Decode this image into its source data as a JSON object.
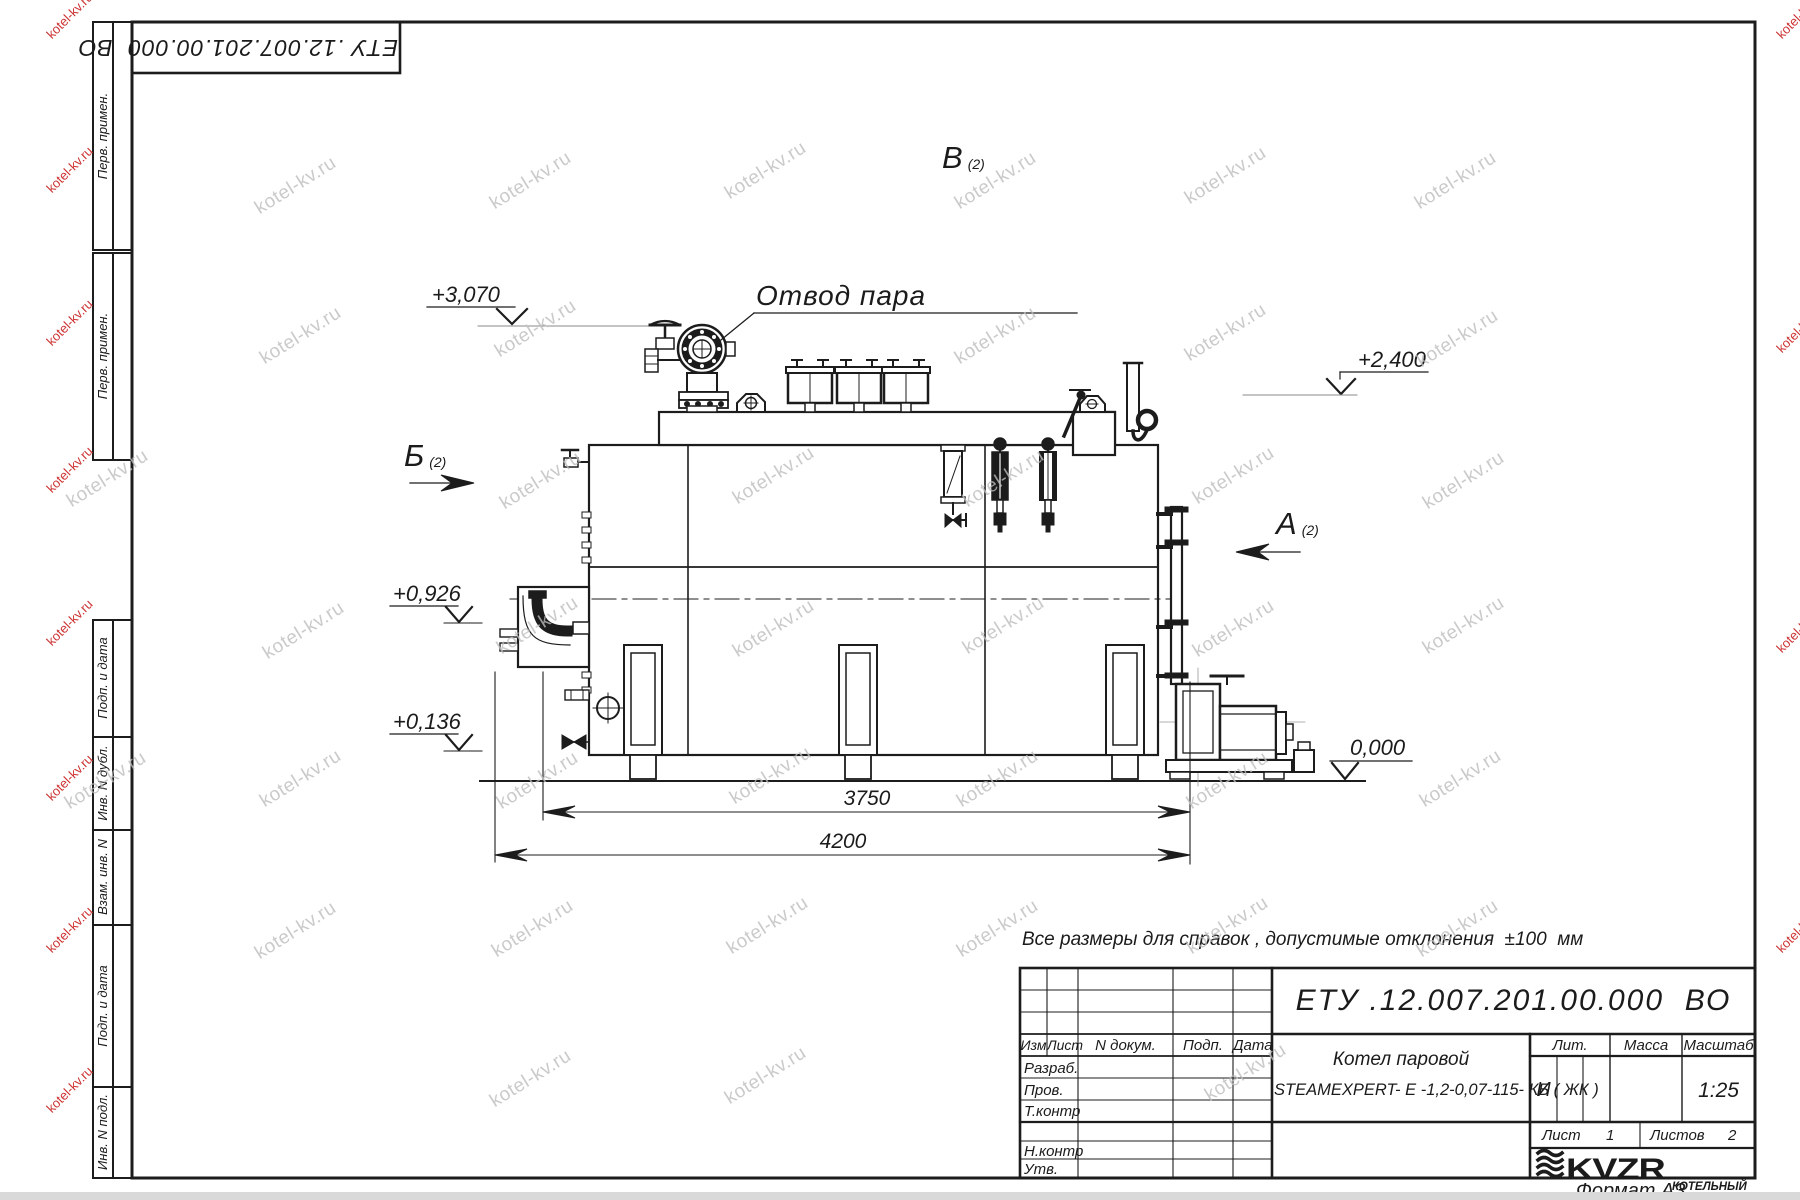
{
  "watermark": {
    "text": "kotel-kv.ru",
    "gray_color": "#bdbdbd",
    "red_color": "#cc3333"
  },
  "stamp": {
    "designation": "ЕТУ .12.007.201.00.000  ВО"
  },
  "margin": {
    "labels": [
      "Перв. примен.",
      "Перв. примен.",
      "Подп. и дата",
      "Инв. N дубл.",
      "Взам. инв. N",
      "Подп. и дата",
      "Инв. N подл."
    ]
  },
  "drawing": {
    "callout_steam_outlet": "Отвод пара",
    "view_b": {
      "letter": "Б",
      "index": "(2)"
    },
    "view_a": {
      "letter": "А",
      "index": "(2)"
    },
    "view_v": {
      "letter": "В",
      "index": "(2)"
    },
    "elev_3070": "+3,070",
    "elev_2400": "+2,400",
    "elev_0926": "+0,926",
    "elev_0136": "+0,136",
    "elev_0000": "0,000",
    "dim_3750": "3750",
    "dim_4200": "4200"
  },
  "note": "Все размеры для справок , допустимые отклонения  ±100  мм",
  "title_block": {
    "designation": "ЕТУ .12.007.201.00.000  ВО",
    "columns": {
      "izm": "Изм",
      "list": "Лист",
      "doc": "N докум.",
      "sign": "Подп.",
      "date": "Дата"
    },
    "rows": {
      "developed": "Разраб.",
      "checked": "Пров.",
      "tcontrol": "Т.контр",
      "ncontrol": "Н.контр",
      "approved": "Утв."
    },
    "lit_label": "Лит.",
    "mass_label": "Масса",
    "scale_label": "Масштаб",
    "lit_value": "И",
    "scale_value": "1:25",
    "product_line1": "Котел паровой",
    "product_line2": "STEAMEXPERT- Е -1,2-0,07-115- КБ ( ЖК )",
    "sheet_label": "Лист",
    "sheet_value": "1",
    "sheets_label": "Листов",
    "sheets_value": "2",
    "logo": "KVZR",
    "company_line1": "КОТЕЛЬНЫЙ",
    "company_line2": "ЗАВОД РЭП",
    "format": "Формат А3"
  }
}
